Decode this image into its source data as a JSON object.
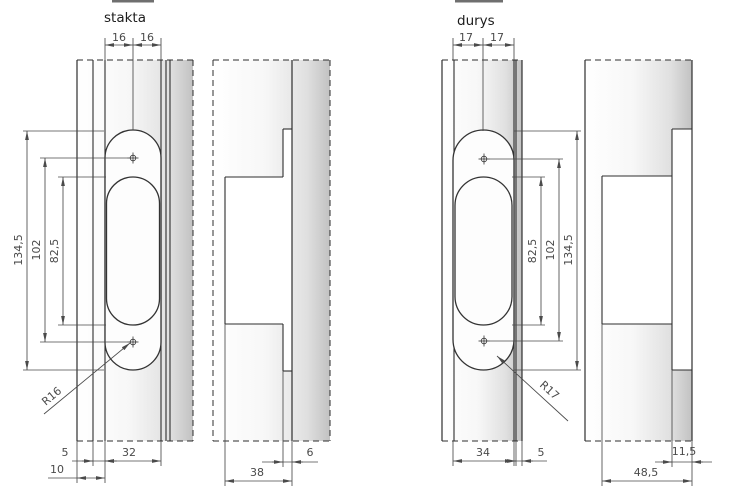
{
  "frame": {
    "title": "stakta",
    "dims": {
      "top_left": "16",
      "top_right": "16",
      "outer_height": "134,5",
      "hole_spacing": "102",
      "inner_height": "82,5",
      "radius": "R16",
      "edge_offset": "5",
      "plate_width": "32",
      "total_offset": "10",
      "slot_depth": "6",
      "pocket_depth": "38"
    }
  },
  "door": {
    "title": "durys",
    "dims": {
      "top_left": "17",
      "top_right": "17",
      "inner_height": "82,5",
      "hole_spacing": "102",
      "outer_height": "134,5",
      "radius": "R17",
      "plate_width": "34",
      "edge_offset": "5",
      "slot_depth": "11,5",
      "pocket_depth": "48,5"
    }
  },
  "colors": {
    "line": "#2e2e2e",
    "dimension": "#4a4a4a",
    "shade_dark": "#c2c2c2",
    "background": "#ffffff"
  }
}
